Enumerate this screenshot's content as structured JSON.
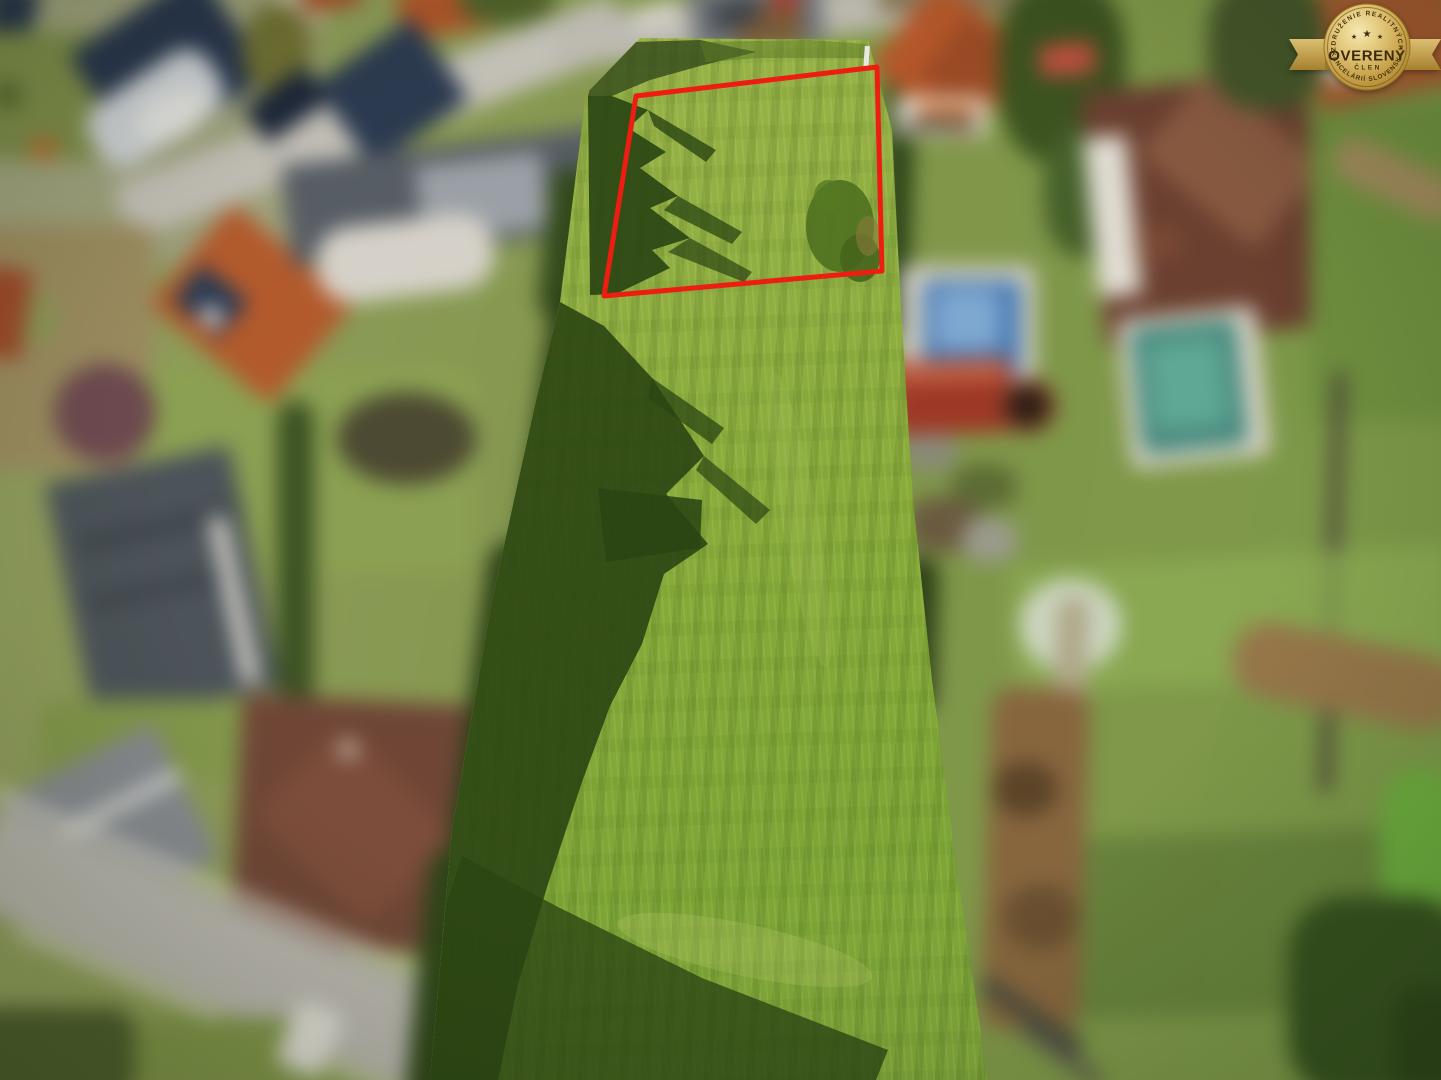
{
  "badge": {
    "arc_top": "ZDRUŽENIE REALITNÝCH",
    "title": "OVERENÝ",
    "member": "ČLEN",
    "arc_bottom": "KANCELÁRIÍ SLOVENSKA",
    "stars": [
      "★",
      "★",
      "★"
    ],
    "colors": {
      "gold_light": "#f0dfa0",
      "gold": "#d2ab58",
      "gold_dark": "#a9832f",
      "text": "#3f2e0d"
    }
  },
  "parcel_overlay": {
    "boundary_points": "636,96 877,67 882,271 604,296",
    "boundary_color": "#ee1d12",
    "boundary_stroke_width": "5"
  },
  "palette": {
    "field_green": "#87ab39",
    "field_shadow_green": "#2b4513",
    "roof_orange": "#b3592c",
    "roof_navy": "#2c3a50",
    "road_gray": "#c0bdb4",
    "pool_blue": "#4a7cb4",
    "pool_teal": "#48897d"
  }
}
